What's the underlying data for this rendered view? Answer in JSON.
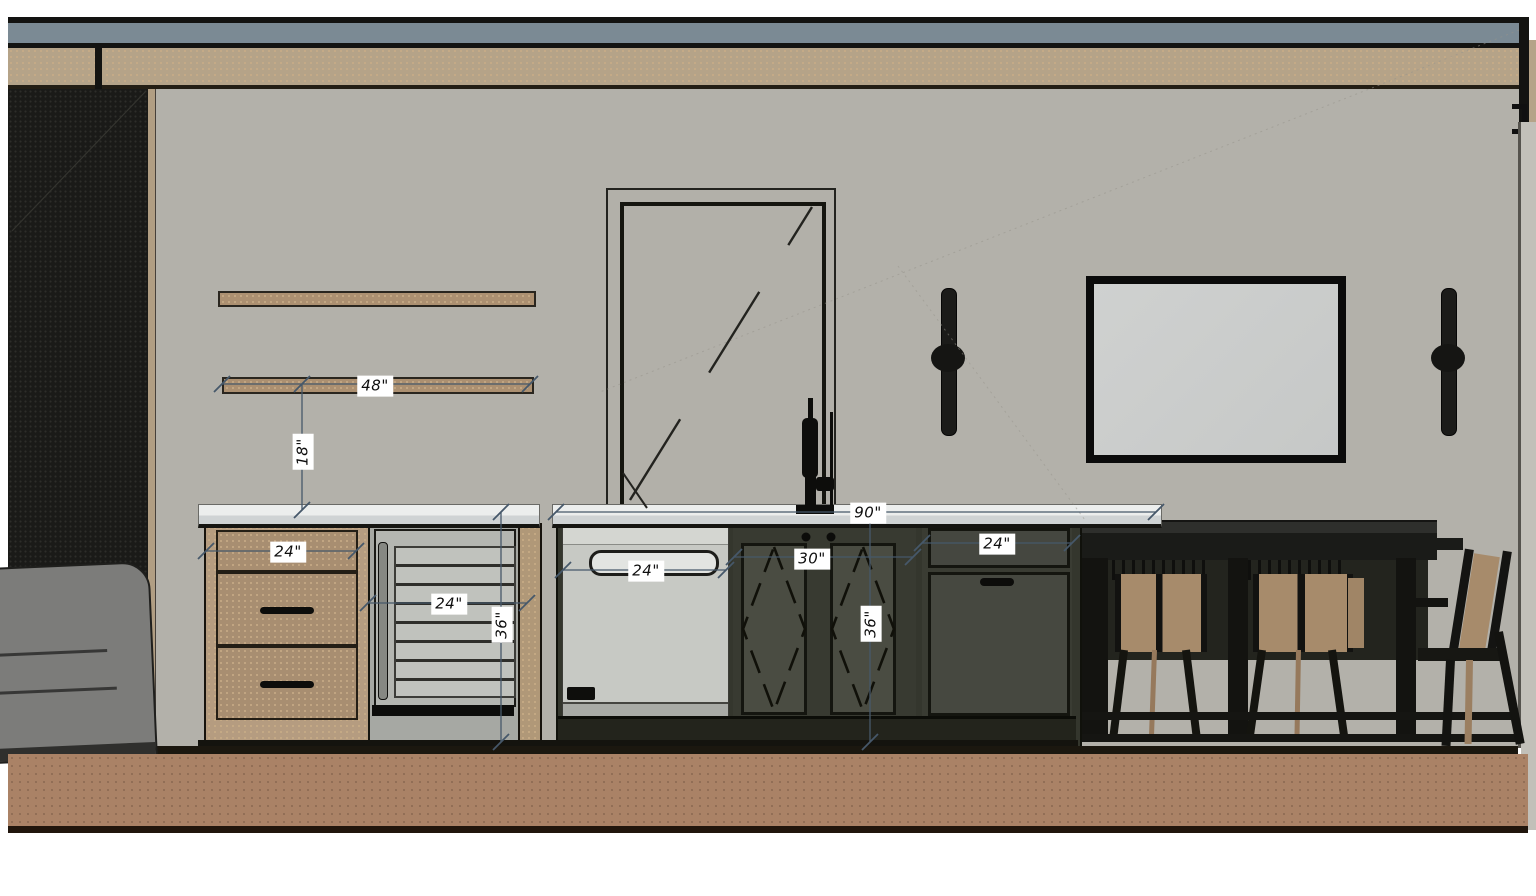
{
  "scene": {
    "title": "Kitchen elevation drawing",
    "view": "interior elevation with dimension annotations",
    "dimension_labels": {
      "shelf_width": "48\"",
      "shelf_to_counter": "18\"",
      "drawer_cabinet_width": "24\"",
      "wine_fridge_width": "24\"",
      "left_run_height": "36\"",
      "dishwasher_width": "24\"",
      "center_cabinet_width": "30\"",
      "island_height": "36\"",
      "island_total_width": "90\"",
      "right_cabinet_width": "24\""
    },
    "objects": {
      "shelves": "two floating wood shelves",
      "door": "glass door with swing diagonal",
      "appliances": [
        "wine fridge",
        "dishwasher"
      ],
      "lighting": [
        "wall sconce left",
        "wall sconce right"
      ],
      "art": "framed wall panel",
      "furniture": [
        "sofa",
        "dining table",
        "bar stools",
        "dining chair"
      ]
    },
    "colors": {
      "ceiling_accent": "#7b8a94",
      "beam": "#b5a388",
      "wall": "#b3b1aa",
      "floor": "#aa8266",
      "island_cabinetry": "#34362d",
      "wood_cabinetry": "#a88e71",
      "countertop": "#eceeed",
      "dimension_line": "#46586a",
      "dark_wall": "#1a1a18"
    }
  }
}
